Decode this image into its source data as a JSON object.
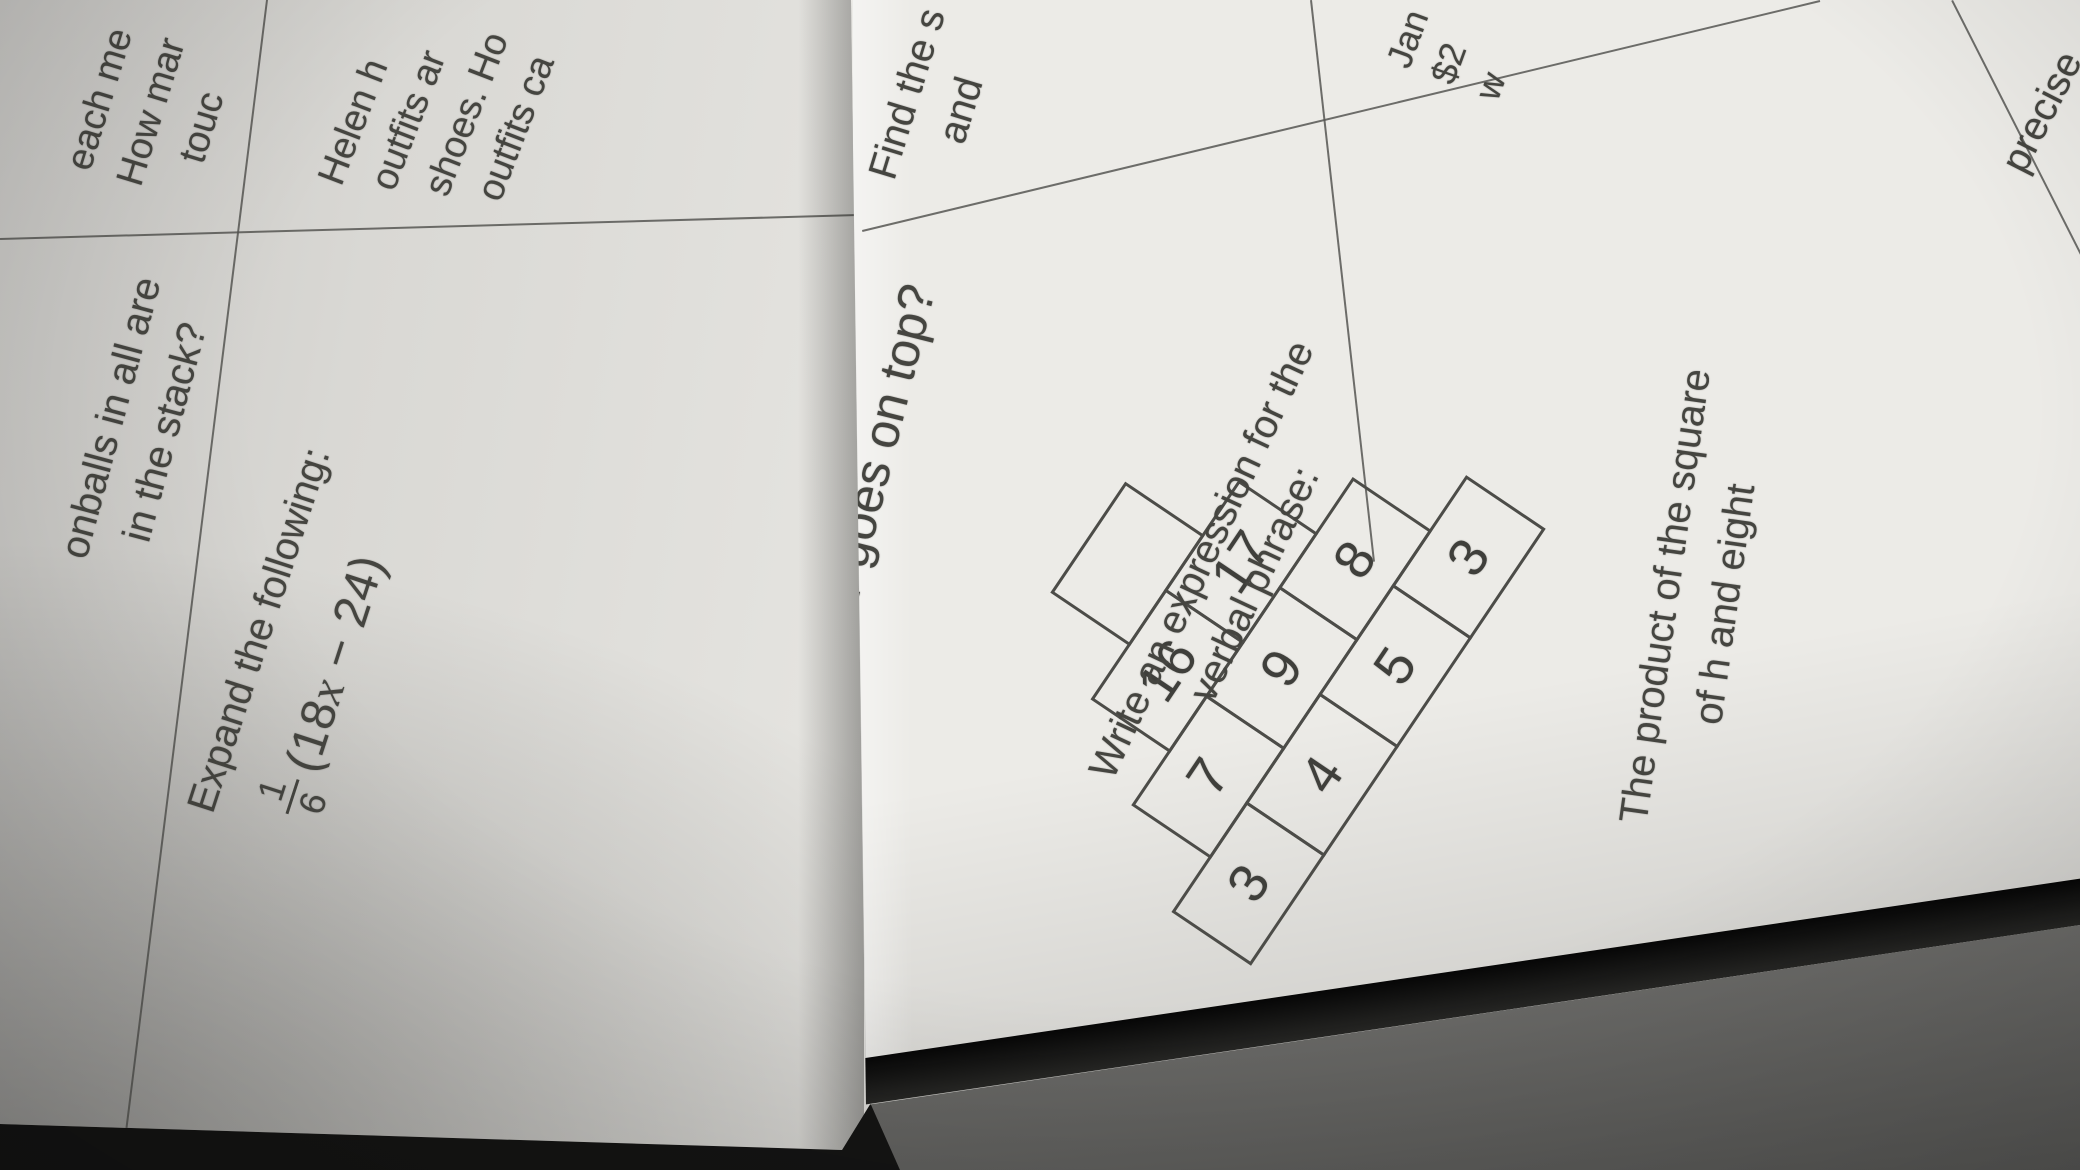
{
  "left_sheet": {
    "problem_fragment_top": {
      "lines": [
        "each me",
        "How mar",
        "touc"
      ]
    },
    "problem_stack": {
      "lines": [
        "onballs in all are",
        "in the stack?"
      ]
    },
    "problem_expand": {
      "title": "Expand the following:",
      "fraction": {
        "numerator": "1",
        "denominator": "6"
      },
      "expression_prefix": "(18",
      "expression_variable": "x",
      "expression_suffix": " − 24)"
    },
    "problem_helen_fragment": {
      "lines": [
        "Helen h",
        "outfits ar",
        "shoes. Ho",
        "outfits ca"
      ]
    }
  },
  "right_sheet": {
    "problem_pyramid": {
      "title": "What number goes on top?",
      "rows": [
        [
          ""
        ],
        [
          "16",
          "17"
        ],
        [
          "7",
          "9",
          "8"
        ],
        [
          "3",
          "4",
          "5",
          "3"
        ]
      ]
    },
    "problem_find_fragment": {
      "lines": [
        "Find the s",
        "and"
      ]
    },
    "problem_jan_fragment": {
      "lines": [
        "Jan",
        "$2",
        "w"
      ]
    },
    "problem_write_expression": {
      "prompt_lines": [
        "Write an expression for the",
        "verbal phrase:"
      ],
      "phrase_lines": [
        "The product of the square",
        "of h and eight"
      ]
    },
    "footer_fragment": "precise"
  }
}
